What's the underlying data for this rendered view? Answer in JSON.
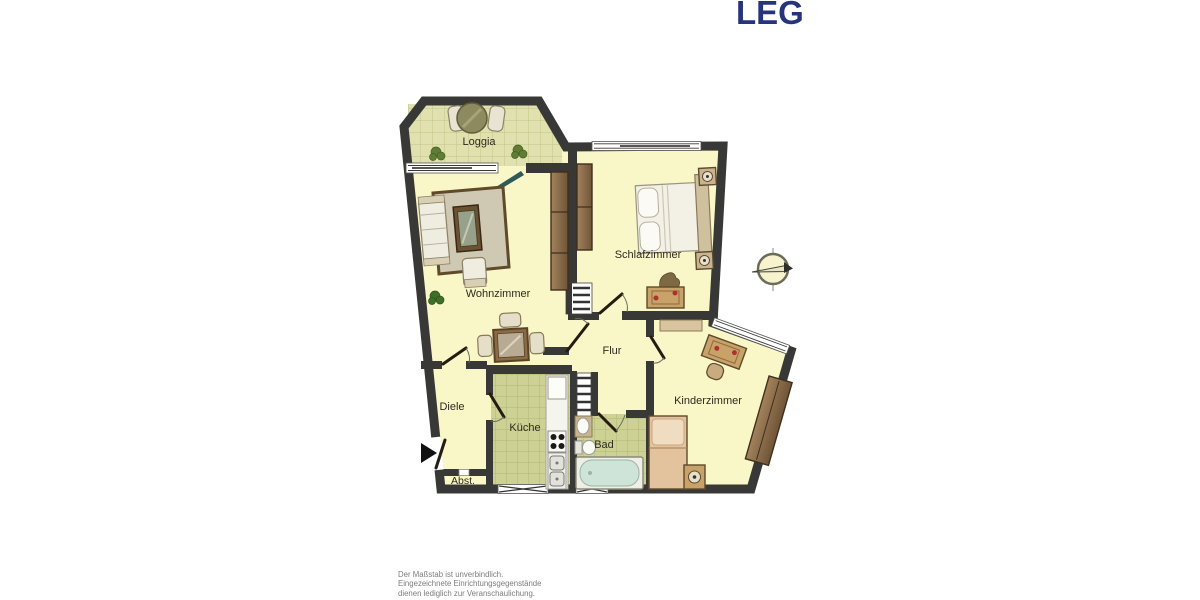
{
  "logo": {
    "text": "LEG"
  },
  "rooms": {
    "loggia": "Loggia",
    "wohnzimmer": "Wohnzimmer",
    "schlafzimmer": "Schlafzimmer",
    "flur": "Flur",
    "diele": "Diele",
    "kueche": "Küche",
    "bad": "Bad",
    "kinderzimmer": "Kinderzimmer",
    "abstellraum": "Abst."
  },
  "footer": {
    "line1": "Der Maßstab ist unverbindlich.",
    "line2": "Eingezeichnete Einrichtungsgegenstände",
    "line3": "dienen lediglich zur Veranschaulichung."
  },
  "icons": {
    "compass": "north-arrow-compass",
    "entrance_arrow": "apartment-entrance-arrow",
    "shaft": "installation-shaft-ladder",
    "balcony_door": "balcony-door-swing"
  },
  "colors": {
    "logo_blue": "#26357b",
    "wall": "#383836",
    "floor_yellow": "#f9f6c8",
    "tile_loggia": "#e0e1ae",
    "tile_wet_room": "#cdd294",
    "wood_dark": "#6f5437",
    "furniture_tan": "#c9a26a",
    "bathtub_water": "#cfe4d8",
    "footer_gray": "#7c7c7c"
  }
}
